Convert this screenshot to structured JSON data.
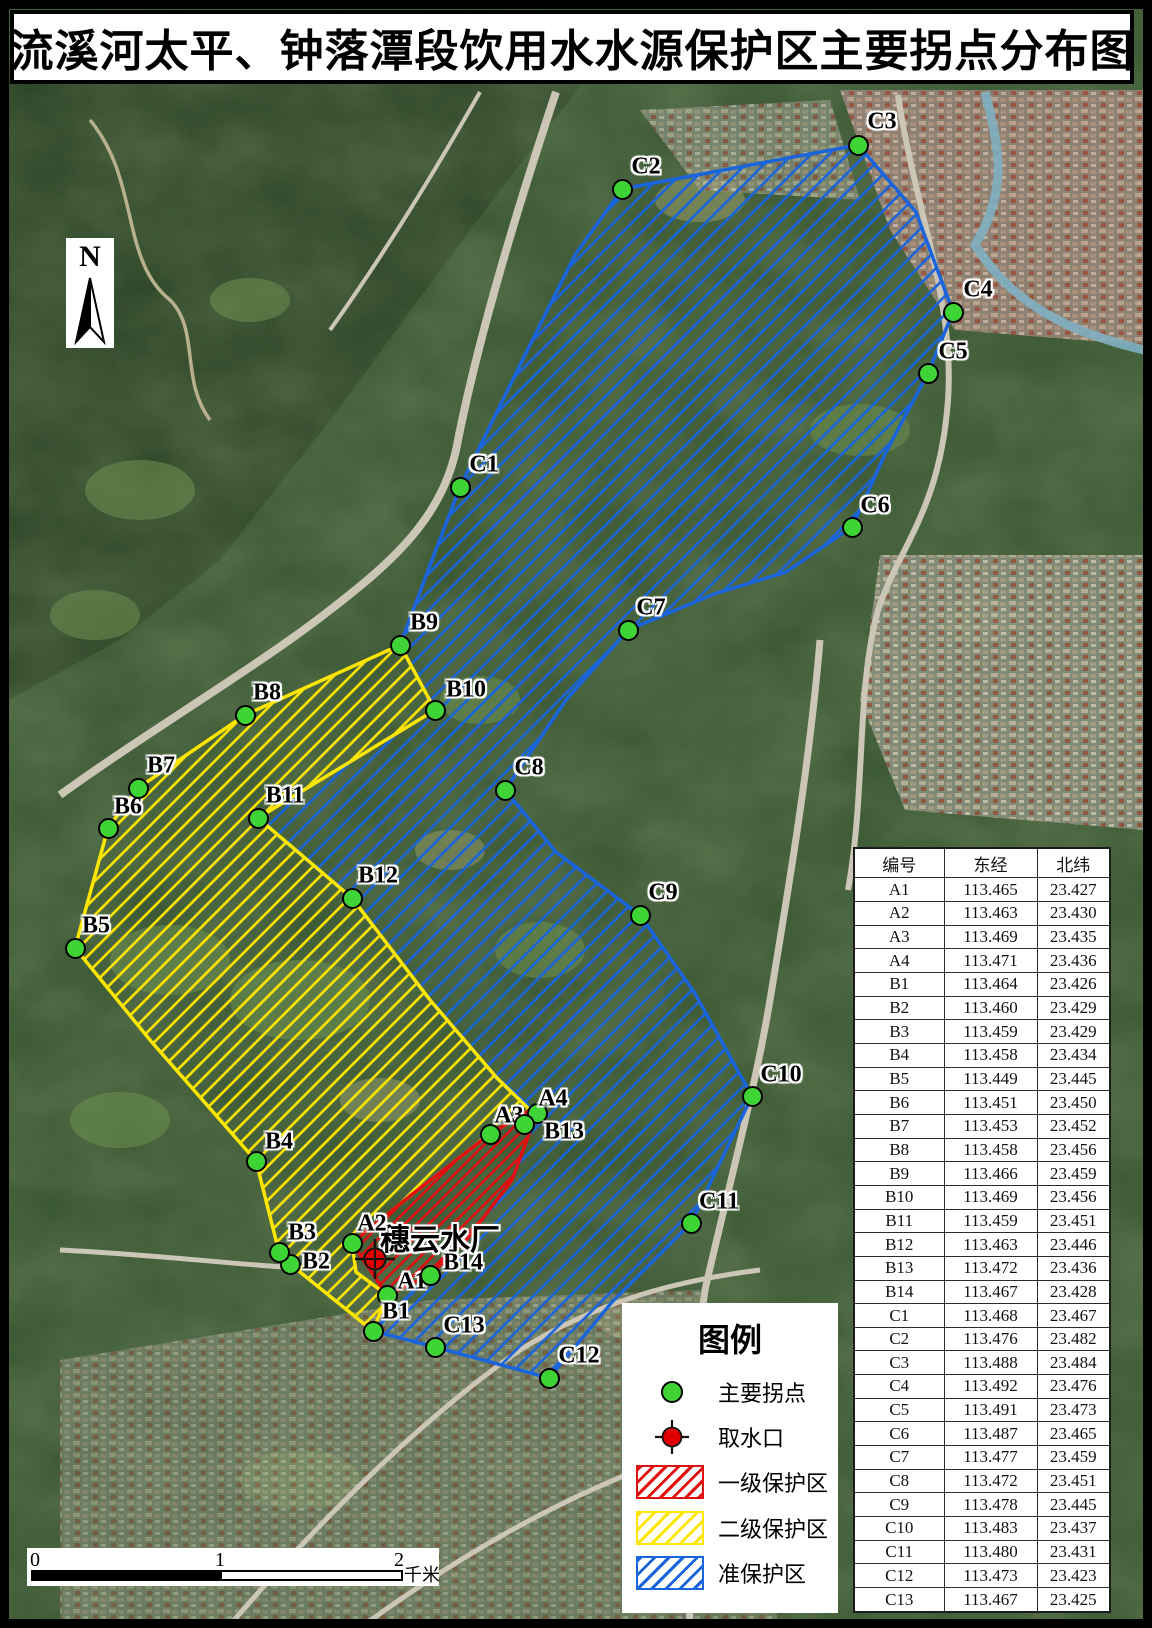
{
  "title": "流溪河太平、钟落潭段饮用水水源保护区主要拐点分布图",
  "north": {
    "label": "N"
  },
  "map": {
    "plant_label": "穗云水厂",
    "intake": {
      "x": 375,
      "y": 1259
    },
    "points": [
      {
        "id": "A1",
        "x": 387,
        "y": 1295,
        "lx": 412,
        "ly": 1282
      },
      {
        "id": "A2",
        "x": 352,
        "y": 1243,
        "lx": 372,
        "ly": 1224
      },
      {
        "id": "A3",
        "x": 490,
        "y": 1134,
        "lx": 509,
        "ly": 1116
      },
      {
        "id": "A4",
        "x": 537,
        "y": 1113,
        "lx": 553,
        "ly": 1099
      },
      {
        "id": "B1",
        "x": 373,
        "y": 1331,
        "lx": 396,
        "ly": 1312
      },
      {
        "id": "B2",
        "x": 290,
        "y": 1264,
        "lx": 316,
        "ly": 1262
      },
      {
        "id": "B3",
        "x": 279,
        "y": 1252,
        "lx": 302,
        "ly": 1233
      },
      {
        "id": "B4",
        "x": 256,
        "y": 1161,
        "lx": 279,
        "ly": 1142
      },
      {
        "id": "B5",
        "x": 75,
        "y": 948,
        "lx": 96,
        "ly": 926
      },
      {
        "id": "B6",
        "x": 108,
        "y": 828,
        "lx": 128,
        "ly": 807
      },
      {
        "id": "B7",
        "x": 138,
        "y": 788,
        "lx": 161,
        "ly": 766
      },
      {
        "id": "B8",
        "x": 245,
        "y": 715,
        "lx": 267,
        "ly": 693
      },
      {
        "id": "B9",
        "x": 400,
        "y": 645,
        "lx": 424,
        "ly": 623
      },
      {
        "id": "B10",
        "x": 435,
        "y": 710,
        "lx": 466,
        "ly": 690
      },
      {
        "id": "B11",
        "x": 258,
        "y": 818,
        "lx": 285,
        "ly": 796
      },
      {
        "id": "B12",
        "x": 352,
        "y": 898,
        "lx": 378,
        "ly": 876
      },
      {
        "id": "B13",
        "x": 524,
        "y": 1124,
        "lx": 564,
        "ly": 1132
      },
      {
        "id": "B14",
        "x": 430,
        "y": 1275,
        "lx": 463,
        "ly": 1263
      },
      {
        "id": "C1",
        "x": 460,
        "y": 487,
        "lx": 484,
        "ly": 465
      },
      {
        "id": "C2",
        "x": 622,
        "y": 189,
        "lx": 646,
        "ly": 167
      },
      {
        "id": "C3",
        "x": 858,
        "y": 145,
        "lx": 882,
        "ly": 122
      },
      {
        "id": "C4",
        "x": 953,
        "y": 312,
        "lx": 978,
        "ly": 290
      },
      {
        "id": "C5",
        "x": 928,
        "y": 373,
        "lx": 953,
        "ly": 352
      },
      {
        "id": "C6",
        "x": 852,
        "y": 527,
        "lx": 875,
        "ly": 506
      },
      {
        "id": "C7",
        "x": 628,
        "y": 630,
        "lx": 651,
        "ly": 608
      },
      {
        "id": "C8",
        "x": 505,
        "y": 790,
        "lx": 529,
        "ly": 768
      },
      {
        "id": "C9",
        "x": 640,
        "y": 915,
        "lx": 663,
        "ly": 893
      },
      {
        "id": "C10",
        "x": 752,
        "y": 1096,
        "lx": 781,
        "ly": 1075
      },
      {
        "id": "C11",
        "x": 691,
        "y": 1223,
        "lx": 719,
        "ly": 1202
      },
      {
        "id": "C12",
        "x": 549,
        "y": 1378,
        "lx": 579,
        "ly": 1356
      },
      {
        "id": "C13",
        "x": 435,
        "y": 1347,
        "lx": 464,
        "ly": 1326
      }
    ]
  },
  "legend": {
    "title": "图例",
    "items": {
      "point": "主要拐点",
      "intake": "取水口",
      "primary": "一级保护区",
      "secondary": "二级保护区",
      "buffer": "准保护区"
    }
  },
  "scalebar": {
    "tick0": "0",
    "tick1": "1",
    "tick2": "2",
    "unit": "千米"
  },
  "table": {
    "headers": [
      "编号",
      "东经",
      "北纬"
    ],
    "rows": [
      [
        "A1",
        "113.465",
        "23.427"
      ],
      [
        "A2",
        "113.463",
        "23.430"
      ],
      [
        "A3",
        "113.469",
        "23.435"
      ],
      [
        "A4",
        "113.471",
        "23.436"
      ],
      [
        "B1",
        "113.464",
        "23.426"
      ],
      [
        "B2",
        "113.460",
        "23.429"
      ],
      [
        "B3",
        "113.459",
        "23.429"
      ],
      [
        "B4",
        "113.458",
        "23.434"
      ],
      [
        "B5",
        "113.449",
        "23.445"
      ],
      [
        "B6",
        "113.451",
        "23.450"
      ],
      [
        "B7",
        "113.453",
        "23.452"
      ],
      [
        "B8",
        "113.458",
        "23.456"
      ],
      [
        "B9",
        "113.466",
        "23.459"
      ],
      [
        "B10",
        "113.469",
        "23.456"
      ],
      [
        "B11",
        "113.459",
        "23.451"
      ],
      [
        "B12",
        "113.463",
        "23.446"
      ],
      [
        "B13",
        "113.472",
        "23.436"
      ],
      [
        "B14",
        "113.467",
        "23.428"
      ],
      [
        "C1",
        "113.468",
        "23.467"
      ],
      [
        "C2",
        "113.476",
        "23.482"
      ],
      [
        "C3",
        "113.488",
        "23.484"
      ],
      [
        "C4",
        "113.492",
        "23.476"
      ],
      [
        "C5",
        "113.491",
        "23.473"
      ],
      [
        "C6",
        "113.487",
        "23.465"
      ],
      [
        "C7",
        "113.477",
        "23.459"
      ],
      [
        "C8",
        "113.472",
        "23.451"
      ],
      [
        "C9",
        "113.478",
        "23.445"
      ],
      [
        "C10",
        "113.483",
        "23.437"
      ],
      [
        "C11",
        "113.480",
        "23.431"
      ],
      [
        "C12",
        "113.473",
        "23.423"
      ],
      [
        "C13",
        "113.467",
        "23.425"
      ]
    ]
  },
  "colors": {
    "primary_zone": "#e01010",
    "secondary_zone": "#ffe600",
    "buffer_zone": "#1a64dc",
    "point_fill": "#3fd435",
    "intake_fill": "#e00000"
  }
}
